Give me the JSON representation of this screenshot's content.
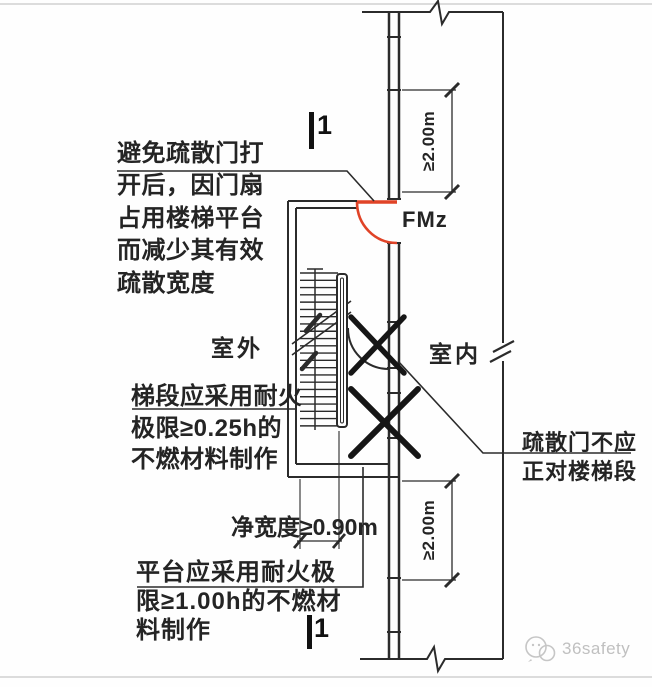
{
  "diagram": {
    "annotations": {
      "door_swing": "避免疏散门打\n开后，因门扇\n占用楼梯平台\n而减少其有效\n疏散宽度",
      "stair_flight": "梯段应采用耐火\n极限≥0.25h的\n不燃材料制作",
      "platform": "平台应采用耐火极\n限≥1.00h的不燃材\n料制作",
      "door_facing": "疏散门不应\n正对楼梯段",
      "clear_width": "净宽度≥0.90m"
    },
    "labels": {
      "outdoor": "室外",
      "indoor": "室内",
      "door_tag": "FMz",
      "section_mark_top": "1",
      "section_mark_bottom": "1",
      "dim_top": "≥2.00m",
      "dim_bottom": "≥2.00m"
    },
    "watermark": "36safety",
    "colors": {
      "line": "#2b2b2b",
      "door": "#e04327",
      "cross": "#161616",
      "watermark": "#c0c0c0"
    }
  }
}
